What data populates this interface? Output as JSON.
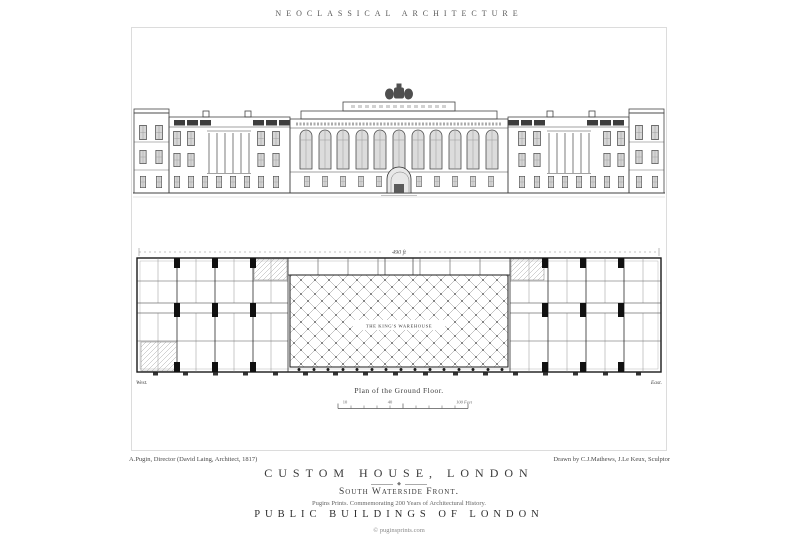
{
  "header": {
    "series_title": "NEOCLASSICAL ARCHITECTURE"
  },
  "plate": {
    "credit_left": "A.Pugin, Director (David Laing, Architect, 1817)",
    "credit_right": "Drawn by C.J.Mathews, J.Le Keux, Sculptor",
    "plan": {
      "caption": "Plan of the Ground Floor.",
      "center_label": "THE KING'S WAREHOUSE",
      "west_label": "West.",
      "east_label": "East.",
      "top_dimension": "490 ft"
    },
    "scale_bar": {
      "left": "10",
      "mid": "40",
      "right": "100 Feet"
    }
  },
  "footer": {
    "title": "CUSTOM HOUSE, LONDON",
    "ornament": "◆",
    "subtitle": "South Waterside Front.",
    "tagline": "Pugins Prints. Commemorating 200 Years of Architectural History.",
    "series": "PUBLIC BUILDINGS OF LONDON",
    "copyright": "© puginsprints.com"
  },
  "colors": {
    "ink": "#3a3a3a",
    "frame": "#dcdcdc",
    "paper": "#ffffff"
  }
}
